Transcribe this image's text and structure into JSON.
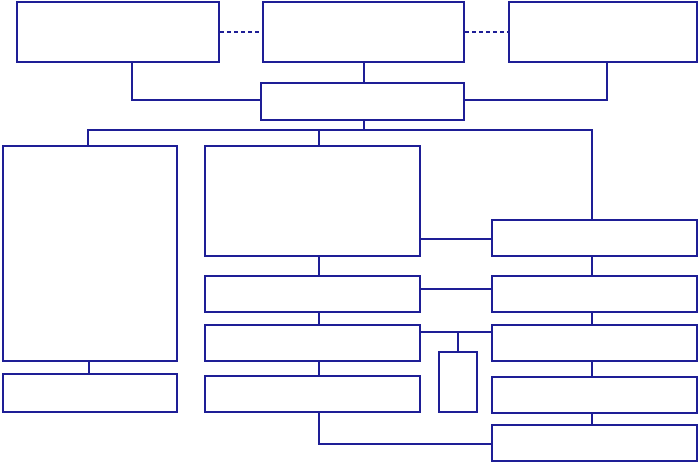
{
  "colors": {
    "line": "#1e1e96",
    "box_fill": "#ffffff",
    "background": "#ffffff"
  },
  "canvas": {
    "width": 700,
    "height": 465
  },
  "diagram": {
    "type": "flowchart",
    "nodes": [
      {
        "id": "top-left",
        "label": "",
        "x": 16,
        "y": 1,
        "w": 204,
        "h": 62
      },
      {
        "id": "top-center",
        "label": "",
        "x": 262,
        "y": 1,
        "w": 203,
        "h": 62
      },
      {
        "id": "top-right",
        "label": "",
        "x": 508,
        "y": 1,
        "w": 190,
        "h": 62
      },
      {
        "id": "hub",
        "label": "",
        "x": 260,
        "y": 82,
        "w": 205,
        "h": 39
      },
      {
        "id": "left-large",
        "label": "",
        "x": 2,
        "y": 145,
        "w": 176,
        "h": 217
      },
      {
        "id": "left-bottom",
        "label": "",
        "x": 2,
        "y": 373,
        "w": 176,
        "h": 40
      },
      {
        "id": "mid-large",
        "label": "",
        "x": 204,
        "y": 145,
        "w": 217,
        "h": 112
      },
      {
        "id": "mid-row2",
        "label": "",
        "x": 204,
        "y": 275,
        "w": 217,
        "h": 38
      },
      {
        "id": "mid-row3",
        "label": "",
        "x": 204,
        "y": 324,
        "w": 217,
        "h": 38
      },
      {
        "id": "mid-row4",
        "label": "",
        "x": 204,
        "y": 375,
        "w": 217,
        "h": 38
      },
      {
        "id": "small-vertical",
        "label": "",
        "x": 438,
        "y": 351,
        "w": 40,
        "h": 62
      },
      {
        "id": "right-row1",
        "label": "",
        "x": 491,
        "y": 219,
        "w": 207,
        "h": 38
      },
      {
        "id": "right-row2",
        "label": "",
        "x": 491,
        "y": 275,
        "w": 207,
        "h": 38
      },
      {
        "id": "right-row3",
        "label": "",
        "x": 491,
        "y": 324,
        "w": 207,
        "h": 38
      },
      {
        "id": "right-row4",
        "label": "",
        "x": 491,
        "y": 376,
        "w": 207,
        "h": 38
      },
      {
        "id": "right-row5",
        "label": "",
        "x": 491,
        "y": 424,
        "w": 207,
        "h": 38
      }
    ],
    "edges": [
      {
        "id": "dash-topleft-topcenter",
        "style": "dashed",
        "x": 220,
        "y": 31,
        "w": 42,
        "h": 2
      },
      {
        "id": "dash-topcenter-topright",
        "style": "dashed",
        "x": 465,
        "y": 31,
        "w": 43,
        "h": 2
      },
      {
        "id": "topleft-drop",
        "style": "solid",
        "x": 131,
        "y": 62,
        "w": 2,
        "h": 39
      },
      {
        "id": "topleft-to-hub",
        "style": "solid",
        "x": 131,
        "y": 99,
        "w": 131,
        "h": 2
      },
      {
        "id": "topcenter-drop",
        "style": "solid",
        "x": 363,
        "y": 62,
        "w": 2,
        "h": 21
      },
      {
        "id": "topright-drop",
        "style": "solid",
        "x": 606,
        "y": 62,
        "w": 2,
        "h": 39
      },
      {
        "id": "topright-to-hub",
        "style": "solid",
        "x": 463,
        "y": 99,
        "w": 145,
        "h": 2
      },
      {
        "id": "hub-drop",
        "style": "solid",
        "x": 363,
        "y": 119,
        "w": 2,
        "h": 12
      },
      {
        "id": "distribution-line",
        "style": "solid",
        "x": 87,
        "y": 129,
        "w": 506,
        "h": 2
      },
      {
        "id": "drop-to-left-large",
        "style": "solid",
        "x": 87,
        "y": 129,
        "w": 2,
        "h": 18
      },
      {
        "id": "drop-to-mid-large",
        "style": "solid",
        "x": 318,
        "y": 129,
        "w": 2,
        "h": 18
      },
      {
        "id": "drop-to-right-row1",
        "style": "solid",
        "x": 591,
        "y": 129,
        "w": 2,
        "h": 92
      },
      {
        "id": "leftlarge-leftbottom",
        "style": "solid",
        "x": 88,
        "y": 360,
        "w": 2,
        "h": 15
      },
      {
        "id": "midlarge-midrow2",
        "style": "solid",
        "x": 318,
        "y": 255,
        "w": 2,
        "h": 22
      },
      {
        "id": "midrow2-midrow3",
        "style": "solid",
        "x": 318,
        "y": 311,
        "w": 2,
        "h": 15
      },
      {
        "id": "midrow3-midrow4",
        "style": "solid",
        "x": 318,
        "y": 360,
        "w": 2,
        "h": 17
      },
      {
        "id": "midrow4-drop",
        "style": "solid",
        "x": 318,
        "y": 411,
        "w": 2,
        "h": 34
      },
      {
        "id": "bottom-run-to-right5",
        "style": "solid",
        "x": 318,
        "y": 443,
        "w": 175,
        "h": 2
      },
      {
        "id": "midlarge-rightrow1",
        "style": "solid",
        "x": 419,
        "y": 238,
        "w": 74,
        "h": 2
      },
      {
        "id": "midrow2-rightrow2",
        "style": "solid",
        "x": 419,
        "y": 288,
        "w": 74,
        "h": 2
      },
      {
        "id": "midrow3-rightrow3",
        "style": "solid",
        "x": 419,
        "y": 331,
        "w": 74,
        "h": 2
      },
      {
        "id": "drop-to-small-vertical",
        "style": "solid",
        "x": 457,
        "y": 331,
        "w": 2,
        "h": 22
      },
      {
        "id": "rightrow1-rightrow2",
        "style": "solid",
        "x": 591,
        "y": 255,
        "w": 2,
        "h": 22
      },
      {
        "id": "rightrow2-rightrow3",
        "style": "solid",
        "x": 591,
        "y": 311,
        "w": 2,
        "h": 15
      },
      {
        "id": "rightrow3-rightrow4",
        "style": "solid",
        "x": 591,
        "y": 360,
        "w": 2,
        "h": 18
      },
      {
        "id": "rightrow4-rightrow5",
        "style": "solid",
        "x": 591,
        "y": 412,
        "w": 2,
        "h": 14
      }
    ]
  }
}
